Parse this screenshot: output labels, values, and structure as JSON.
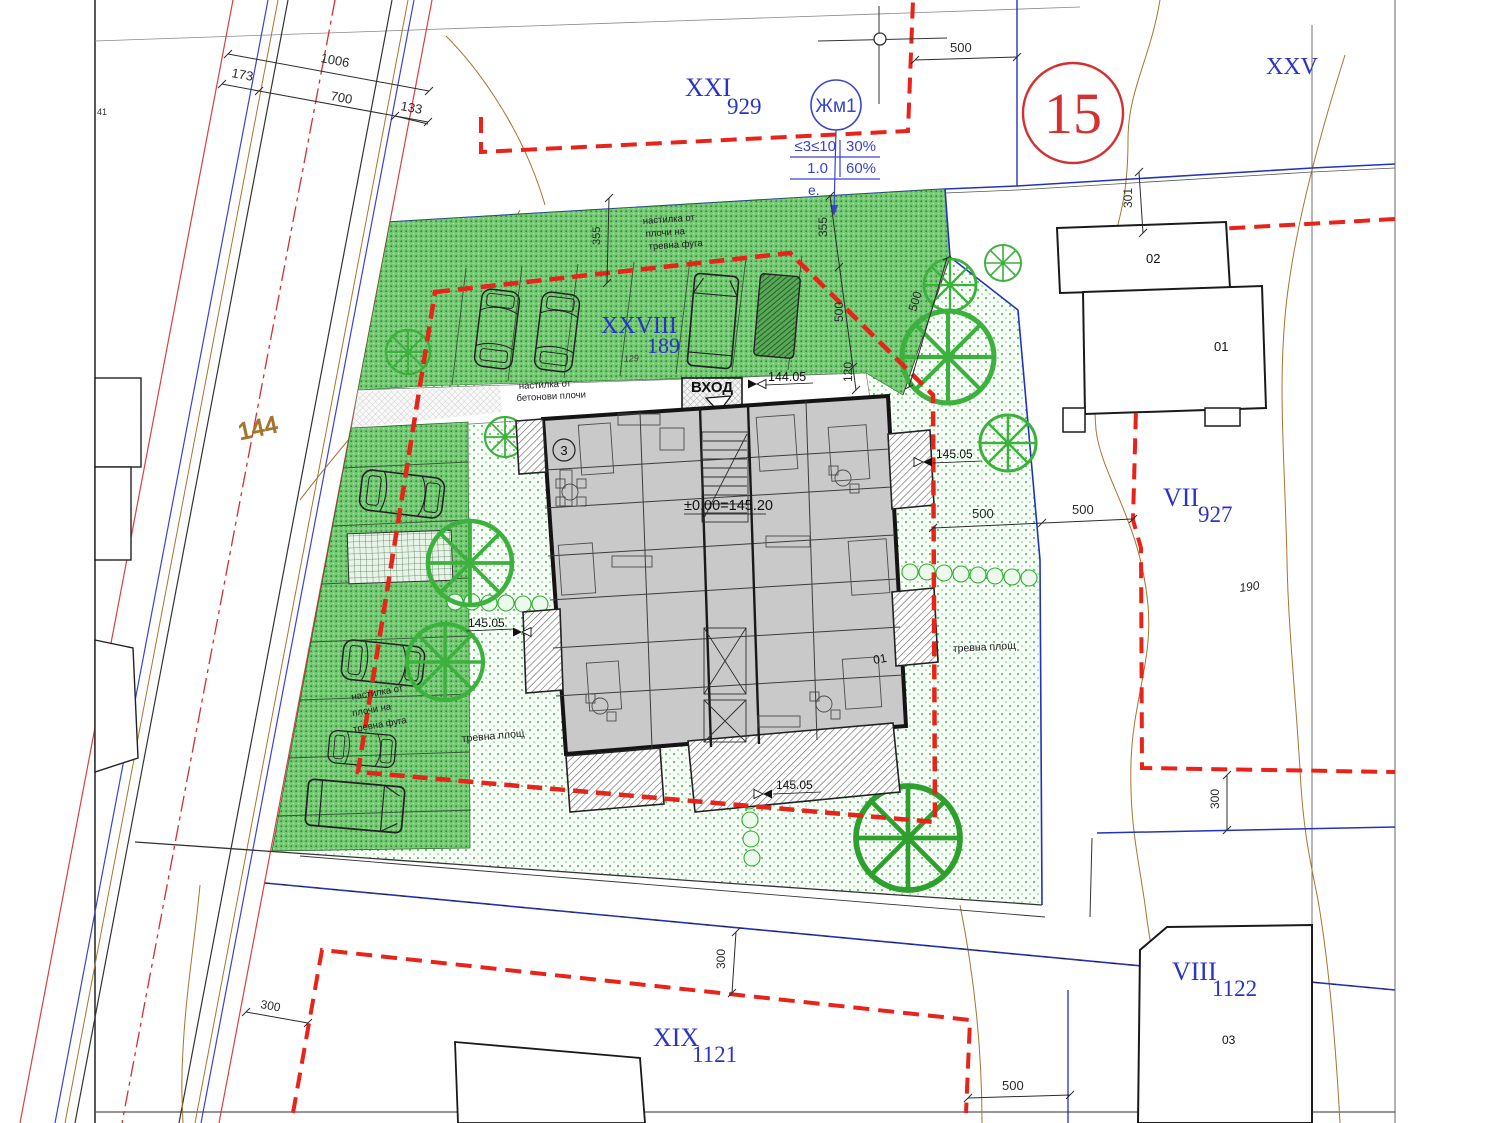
{
  "colors": {
    "boundary_red": "#e8231a",
    "plot_blue": "#2a35c8",
    "contour_brown": "#a5752f",
    "grass_green": "#52c852",
    "dense_green": "#74c874",
    "building_gray": "#c9c9c9",
    "sheet_red": "#d53030"
  },
  "plots": {
    "xxi": {
      "roman": "XXI",
      "number": "929"
    },
    "xxviii": {
      "roman": "XXVIII",
      "number": "189"
    },
    "vii": {
      "roman": "VII",
      "number": "927"
    },
    "viii": {
      "roman": "VIII",
      "number": "1122"
    },
    "xix": {
      "roman": "XIX",
      "number": "1121"
    },
    "xxv": {
      "roman": "XXV"
    }
  },
  "zone": {
    "name": "Жм1",
    "row1": {
      "left": "≤3≤10",
      "right": "30%"
    },
    "row2": {
      "left": "1.0",
      "right": "60%"
    },
    "note": "е."
  },
  "sheet_number": "15",
  "building": {
    "entrance_label": "ВХОД",
    "entrance_level": "144.05",
    "ground_level": "±0.00=145.20",
    "room_badge": "3",
    "number": "01"
  },
  "neighbor_buildings": {
    "b02": "02",
    "b01": "01",
    "b03": "03"
  },
  "spot_levels": {
    "left": "145.05",
    "right": "145.05",
    "bottom": "145.05"
  },
  "surfaces": {
    "top_parking": [
      "настилка от",
      "плочи на",
      "тревна фуга"
    ],
    "entry_path": [
      "настилка от",
      "бетонови плочи"
    ],
    "left_parking": [
      "настилка от",
      "плочи на",
      "тревна фуга"
    ],
    "grass_left": "тревна площ",
    "grass_right": "тревна площ"
  },
  "dimensions": {
    "street_top": {
      "d173": "173",
      "d1006": "1006",
      "d700": "700",
      "d133": "133"
    },
    "top_500": "500",
    "chain_right": {
      "d355": "355",
      "d500": "500",
      "d120": "120"
    },
    "chain_left": "355",
    "diag_500": "500",
    "r301": "301",
    "mid_500a": "500",
    "mid_500b": "500",
    "right_300": "300",
    "bottom_300": "300",
    "bottom_left_300": "300",
    "bottom_500": "500"
  },
  "land_marks": {
    "contour_144": "144",
    "plot_190": "190",
    "stall_129": "129",
    "edge_41": "41"
  }
}
